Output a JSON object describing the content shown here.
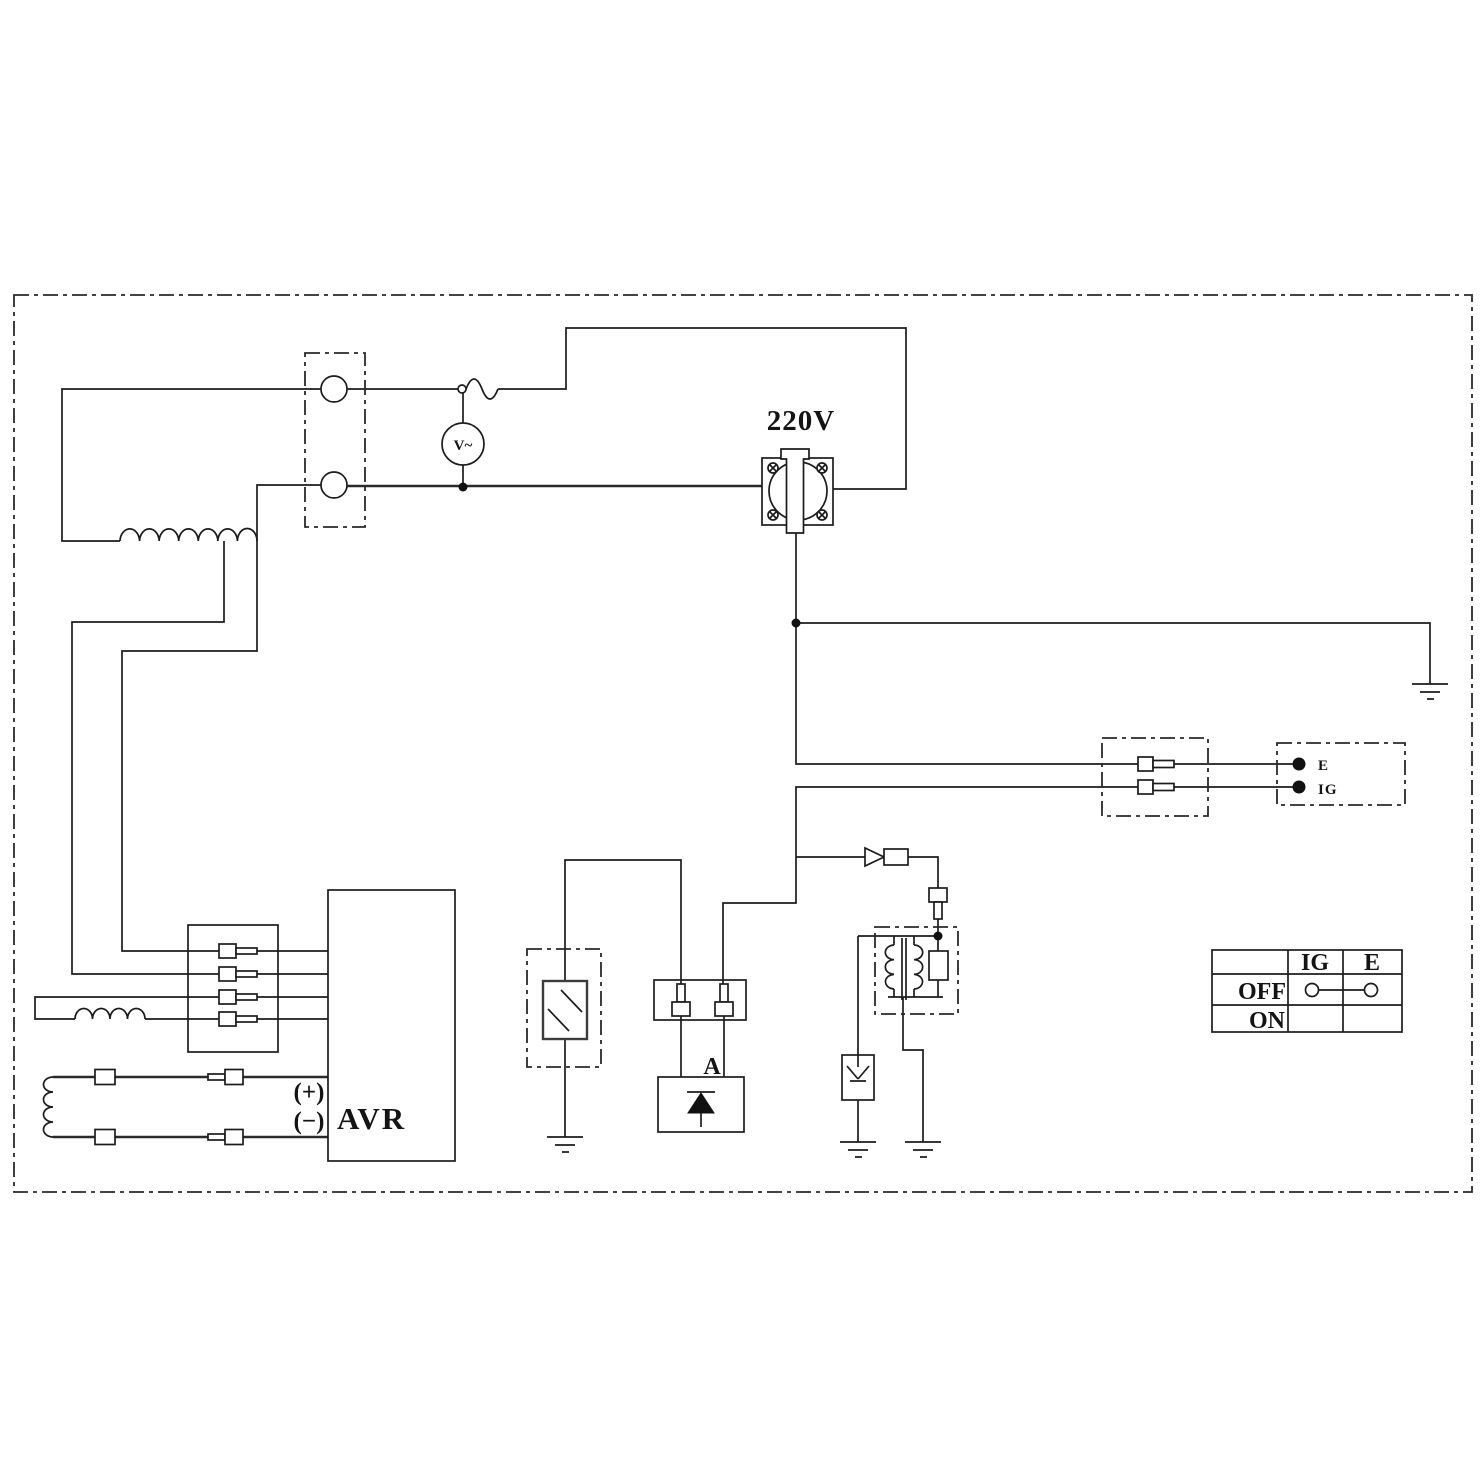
{
  "labels": {
    "voltage": "220V",
    "voltmeter": "V~",
    "terminal_e": "E",
    "terminal_ig": "IG",
    "plus": "(+)",
    "minus": "(−)",
    "avr": "AVR",
    "assembly_a": "A"
  },
  "switch_table": {
    "col_ig": "IG",
    "col_e": "E",
    "row_off": "OFF",
    "row_on": "ON"
  },
  "colors": {
    "line": "#1c1c1c",
    "background": "#ffffff"
  }
}
